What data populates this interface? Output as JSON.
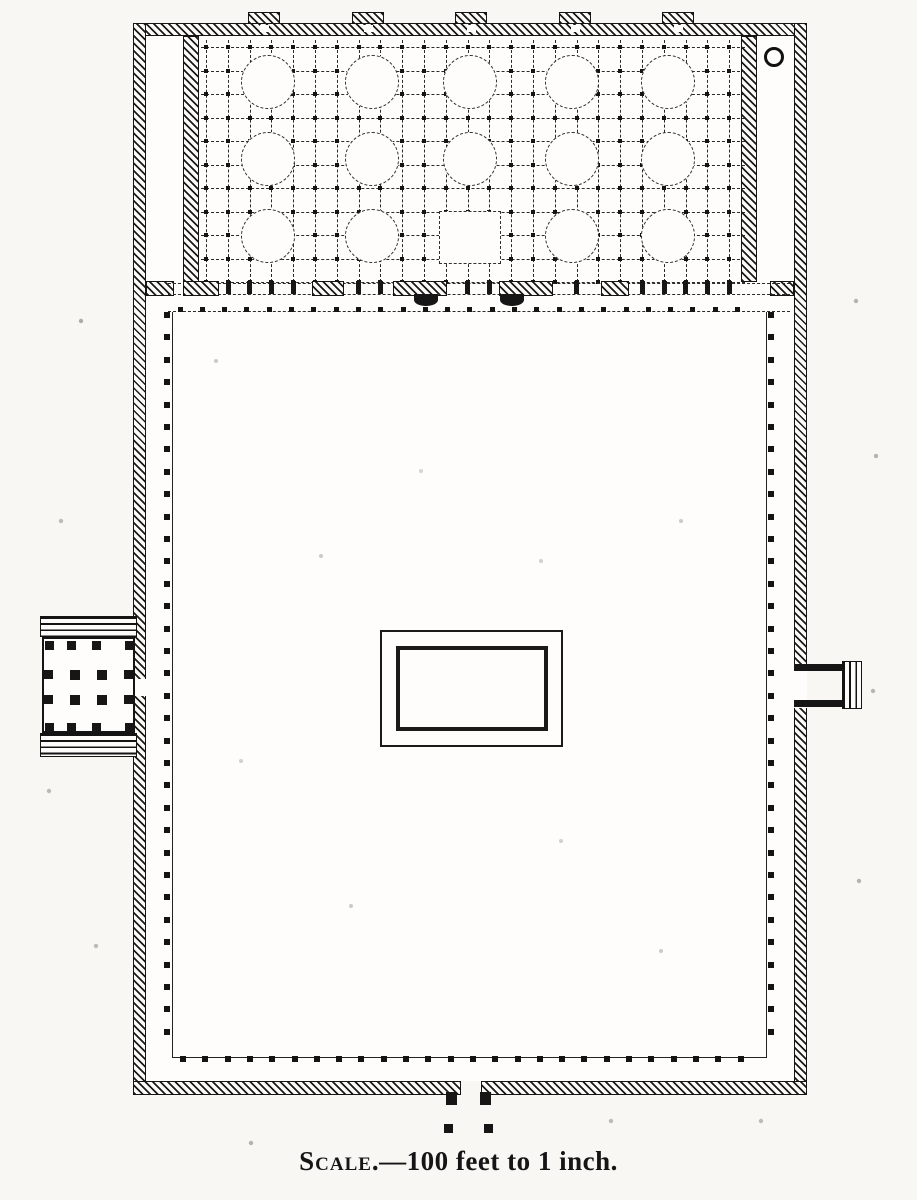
{
  "caption": {
    "label": "Scale",
    "rest": ".—100 feet to 1 inch."
  },
  "palette": {
    "ink": "#1a1a1a",
    "paper": "#f9f7f3"
  },
  "plan": {
    "shapes": [
      [
        "plan-interior",
        "white",
        146,
        36,
        648,
        1045
      ],
      [
        "north-wall",
        "hatch",
        133,
        23,
        674,
        13
      ],
      [
        "west-wall",
        "hatch",
        133,
        23,
        13,
        1072
      ],
      [
        "east-wall",
        "hatch",
        794,
        23,
        13,
        1072
      ],
      [
        "south-wall-left",
        "hatch",
        133,
        1081,
        328,
        14
      ],
      [
        "south-wall-right",
        "hatch",
        481,
        1081,
        326,
        14
      ],
      [
        "hall-west-partition",
        "hatch",
        183,
        36,
        16,
        246
      ],
      [
        "hall-east-partition",
        "hatch",
        741,
        36,
        16,
        246
      ],
      [
        "west-stub-wall",
        "hatch",
        146,
        281,
        28,
        15
      ],
      [
        "east-stub-wall",
        "hatch",
        770,
        281,
        24,
        15
      ],
      [
        "west-gate-passage-gap",
        "white",
        133,
        679,
        13,
        17
      ],
      [
        "east-gate-passage-gap",
        "white",
        794,
        666,
        13,
        42
      ]
    ],
    "hall_grid": {
      "x0": 206,
      "dx": 21.8,
      "cols": 25,
      "y0": 47,
      "dy": 23.5,
      "rows": 11,
      "left": 201,
      "right": 745,
      "top": 40,
      "bottom": 282,
      "dot": 4
    },
    "domes": {
      "r": 27,
      "cx": [
        268,
        372,
        470,
        572,
        668
      ],
      "cy": [
        82,
        159,
        236
      ],
      "skip": [
        [
          2,
          2
        ]
      ]
    },
    "empty_bay": [
      439,
      211,
      62,
      53
    ],
    "minaret": [
      764,
      47,
      20,
      20
    ],
    "buttresses": {
      "centers": [
        264,
        368,
        471,
        575,
        678
      ],
      "y": 12,
      "w": 32,
      "h": 12,
      "notch_w": 9,
      "notch_h": 7,
      "notch_y": 25
    },
    "boundary": {
      "lines": [
        [
          168,
          283,
          622
        ],
        [
          168,
          294,
          622
        ]
      ],
      "piers": [
        [
          183,
          36
        ],
        [
          312,
          32
        ],
        [
          393,
          54
        ],
        [
          499,
          54
        ],
        [
          601,
          28
        ]
      ],
      "pier_y": 281,
      "pier_h": 15,
      "ticks": {
        "x0": 228,
        "step": 21.8,
        "x1": 740,
        "y": 281,
        "w": 5,
        "h": 13
      },
      "bulges": [
        [
          414,
          294,
          24,
          12
        ],
        [
          500,
          294,
          24,
          12
        ]
      ]
    },
    "vestibule": {
      "line": [
        168,
        311,
        622
      ],
      "dot_y": 307,
      "x0": 180,
      "x1": 757,
      "step": 22.3,
      "size": 5
    },
    "arcade": {
      "rect": [
        172,
        312,
        595,
        746
      ],
      "left_x": 164,
      "right_x": 768,
      "v0": 312,
      "v1": 1046,
      "v_step": 22.4,
      "bottom_y": 1056,
      "h0": 180,
      "h1": 757,
      "h_step": 22.3,
      "size": 6
    },
    "fountain": {
      "outer": [
        380,
        630,
        183,
        117
      ],
      "inner": [
        396,
        646,
        152,
        85
      ]
    },
    "west_gate": {
      "stairs_top": [
        40,
        616,
        97,
        21
      ],
      "stairs_bottom": [
        40,
        733,
        97,
        24
      ],
      "hall": [
        42,
        637,
        93,
        96
      ],
      "piers": [
        [
          70,
          670
        ],
        [
          97,
          670
        ],
        [
          70,
          695
        ],
        [
          97,
          695
        ]
      ],
      "pier_size": 10,
      "pilasters": [
        [
          45,
          641
        ],
        [
          67,
          641
        ],
        [
          92,
          641
        ],
        [
          125,
          641
        ],
        [
          45,
          723
        ],
        [
          67,
          723
        ],
        [
          92,
          723
        ],
        [
          125,
          723
        ],
        [
          44,
          670
        ],
        [
          44,
          695
        ],
        [
          124,
          670
        ],
        [
          124,
          695
        ]
      ],
      "pilaster_size": 9
    },
    "east_gate": {
      "north_wall": [
        794,
        664,
        50,
        7
      ],
      "south_wall": [
        794,
        700,
        50,
        7
      ],
      "stairs": [
        842,
        661,
        20,
        48
      ]
    },
    "south_entrance": {
      "caps": [
        [
          446,
          1092,
          11,
          13
        ],
        [
          480,
          1092,
          11,
          13
        ]
      ],
      "posts": [
        [
          444,
          1124,
          9,
          9
        ],
        [
          484,
          1124,
          9,
          9
        ]
      ]
    }
  }
}
